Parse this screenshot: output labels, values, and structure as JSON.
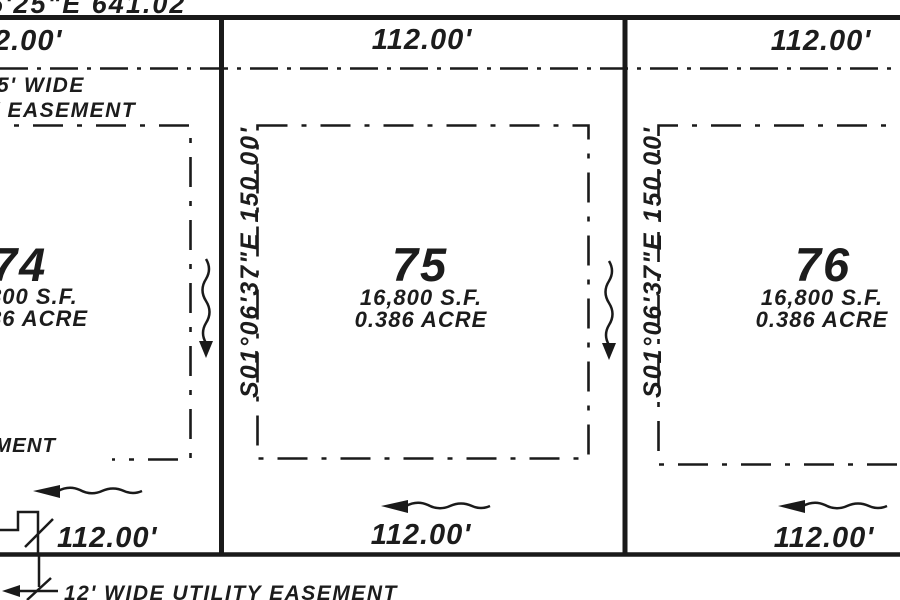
{
  "document": {
    "kind": "plat survey drawing"
  },
  "colors": {
    "ink": "#1c1c1c",
    "paper": "#ffffff"
  },
  "bearings": {
    "top_fragment": "5'25\"E 641.02",
    "left_side": "S01°06'37\"E 150.00'",
    "right_side": "S01°06'37\"E 150.00'"
  },
  "north_dimensions": {
    "left": "2.00'",
    "center": "112.00'",
    "right": "112.00'"
  },
  "south_dimensions": {
    "left": "112.00'",
    "center": "112.00'",
    "right": "112.00'"
  },
  "easements": {
    "top_label_line1": "5' WIDE",
    "top_label_line2": "Y EASEMENT",
    "left_fragment": "MENT",
    "bottom_label": "12' WIDE UTILITY EASEMENT"
  },
  "lots": [
    {
      "number": "74",
      "area_sf": "800 S.F.",
      "area_acre": "86 ACRE"
    },
    {
      "number": "75",
      "area_sf": "16,800 S.F.",
      "area_acre": "0.386 ACRE"
    },
    {
      "number": "76",
      "area_sf": "16,800 S.F.",
      "area_acre": "0.386 ACRE"
    }
  ]
}
